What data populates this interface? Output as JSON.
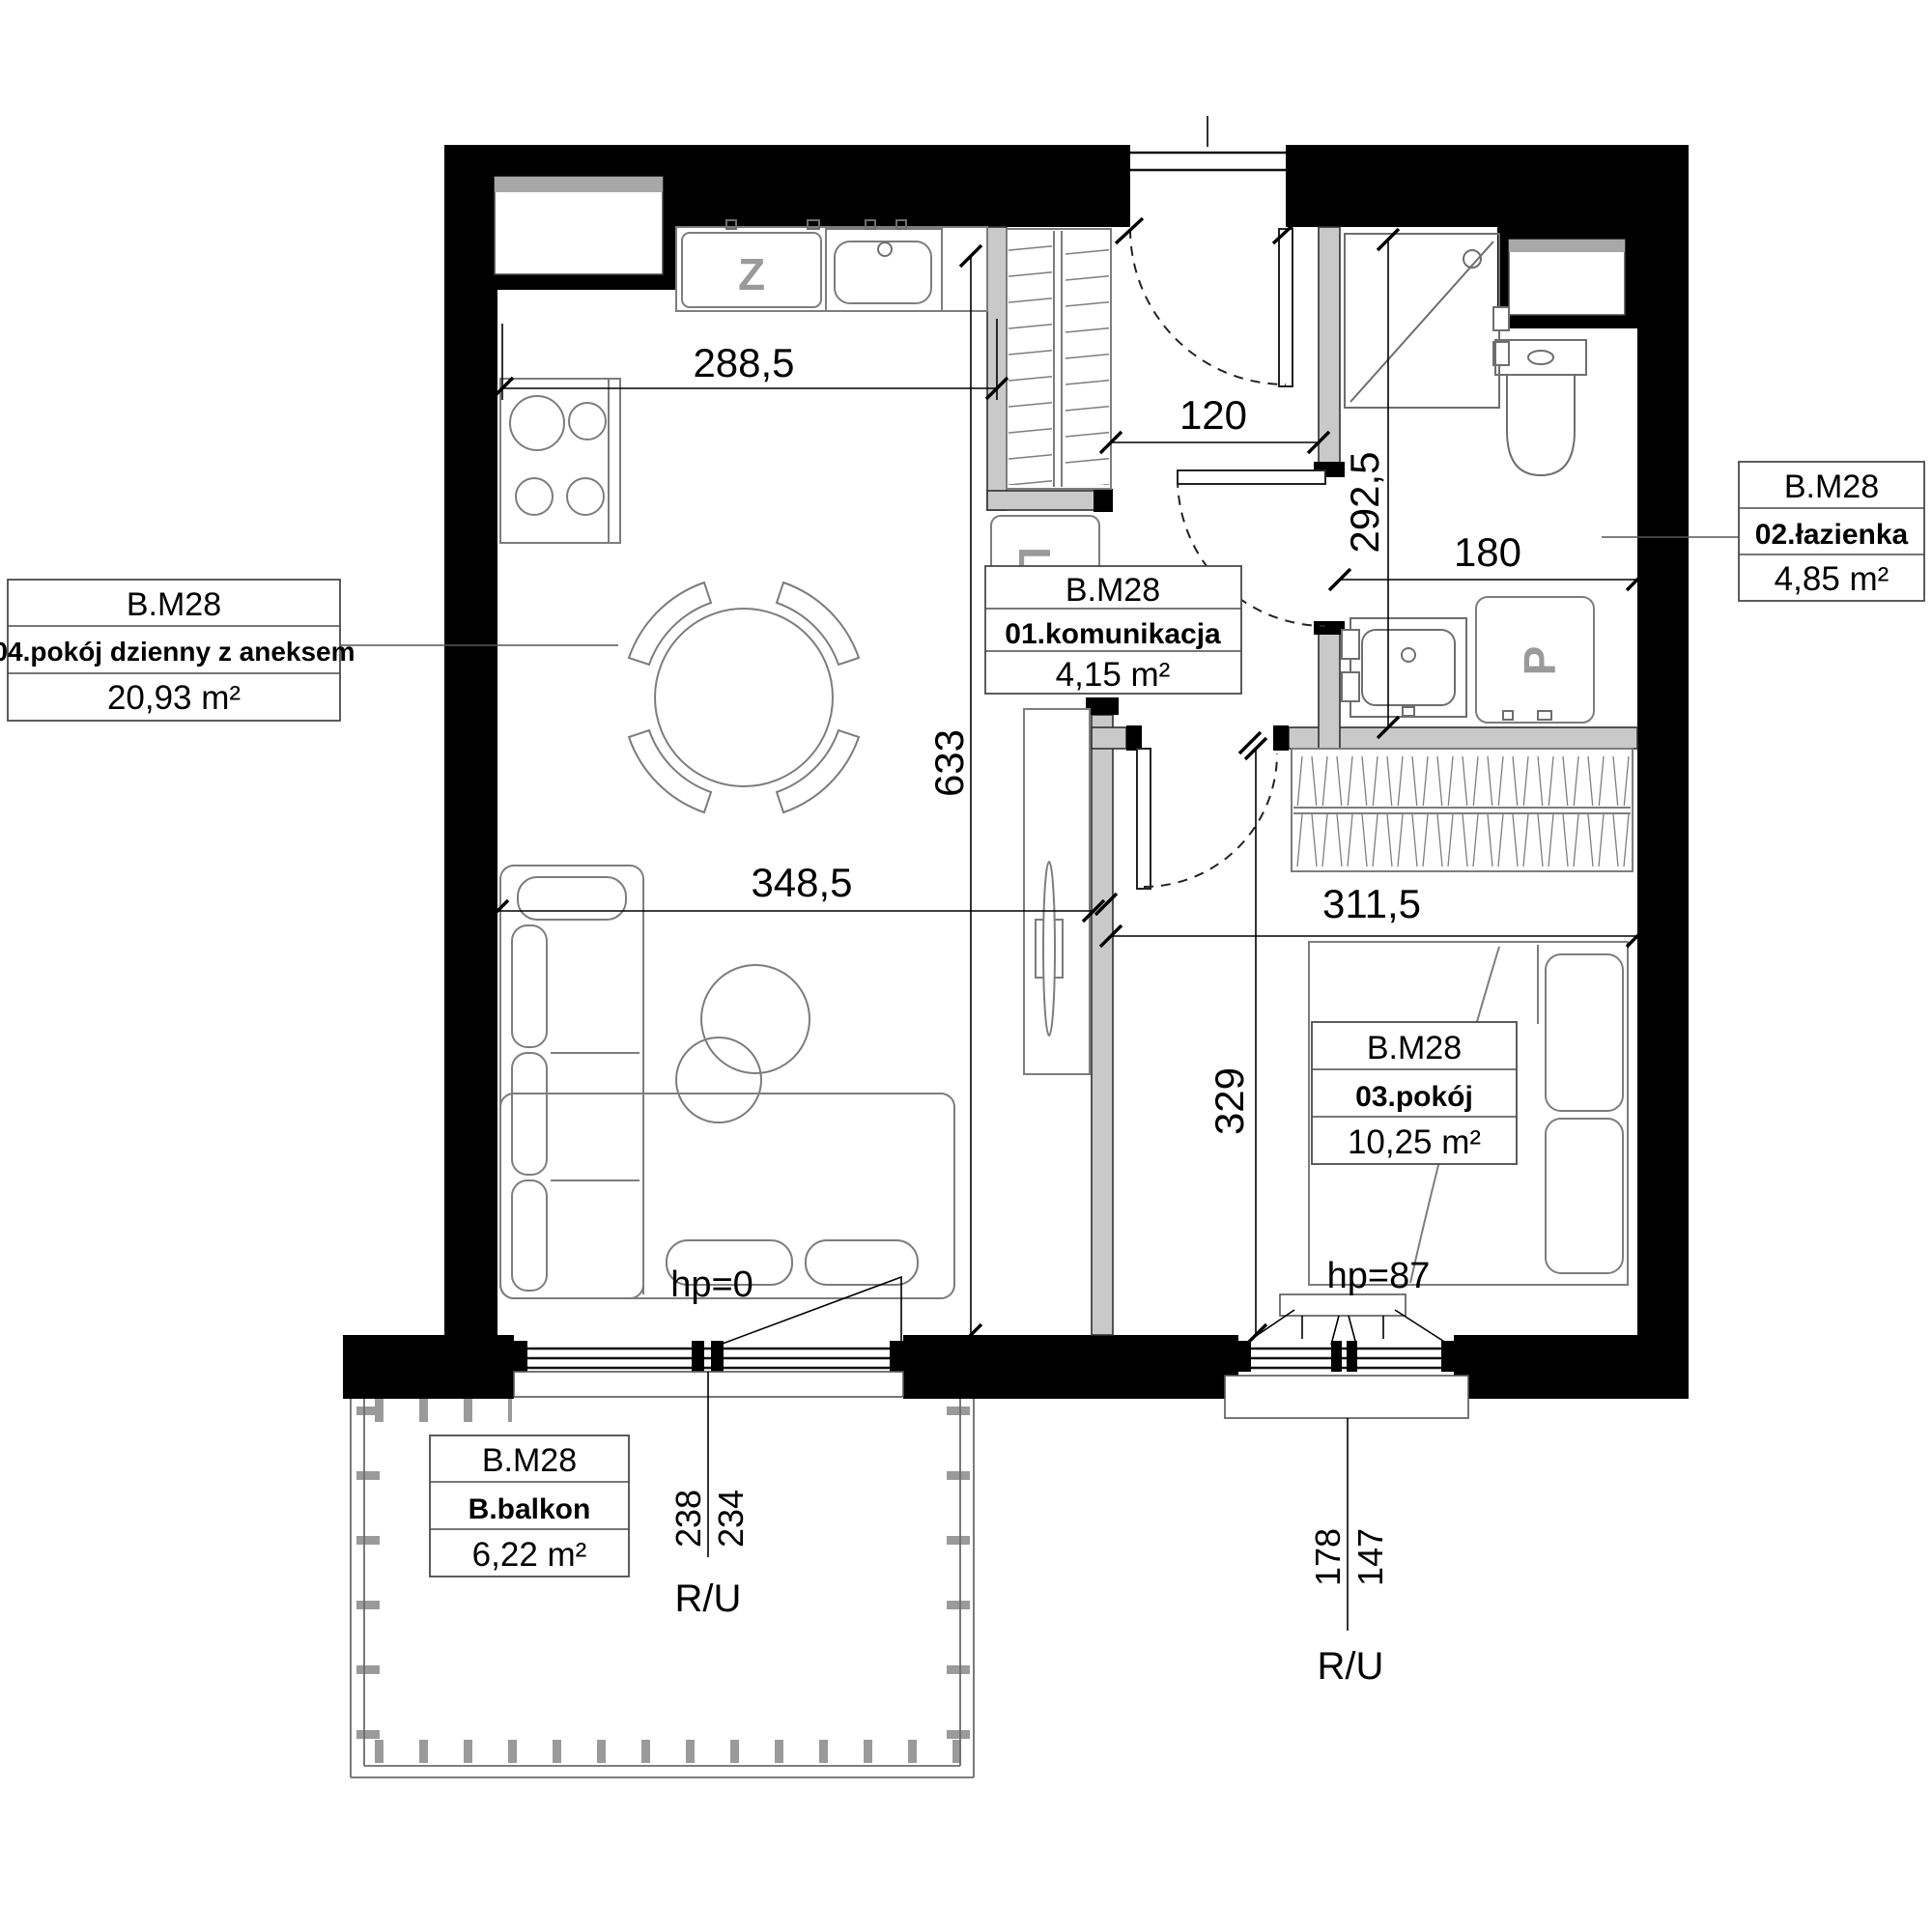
{
  "unit_id": "B.M28",
  "rooms": {
    "hall": {
      "unit": "B.M28",
      "name": "01.komunikacja",
      "area": "4,15 m²"
    },
    "bathroom": {
      "unit": "B.M28",
      "name": "02.łazienka",
      "area": "4,85 m²"
    },
    "bedroom": {
      "unit": "B.M28",
      "name": "03.pokój",
      "area": "10,25 m²"
    },
    "living": {
      "unit": "B.M28",
      "name": "04.pokój dzienny z aneksem",
      "area": "20,93 m²"
    },
    "balcony": {
      "unit": "B.M28",
      "name": "B.balkon",
      "area": "6,22 m²"
    }
  },
  "dimensions": {
    "kitchen_run": "288,5",
    "hall_width": "120",
    "bathroom_depth": "292,5",
    "bathroom_width": "180",
    "living_depth": "633",
    "living_width": "348,5",
    "bedroom_width": "311,5",
    "bedroom_depth": "329"
  },
  "levels": {
    "living_parapet": "hp=0",
    "bedroom_parapet": "hp=87"
  },
  "windows": {
    "balcony_door": {
      "width_a": "238",
      "width_b": "234",
      "type": "R/U"
    },
    "bedroom_window": {
      "width_a": "178",
      "width_b": "147",
      "type": "R/U"
    }
  },
  "appliances": {
    "dishwasher": "Z",
    "fridge": "L",
    "washing_machine": "P"
  }
}
